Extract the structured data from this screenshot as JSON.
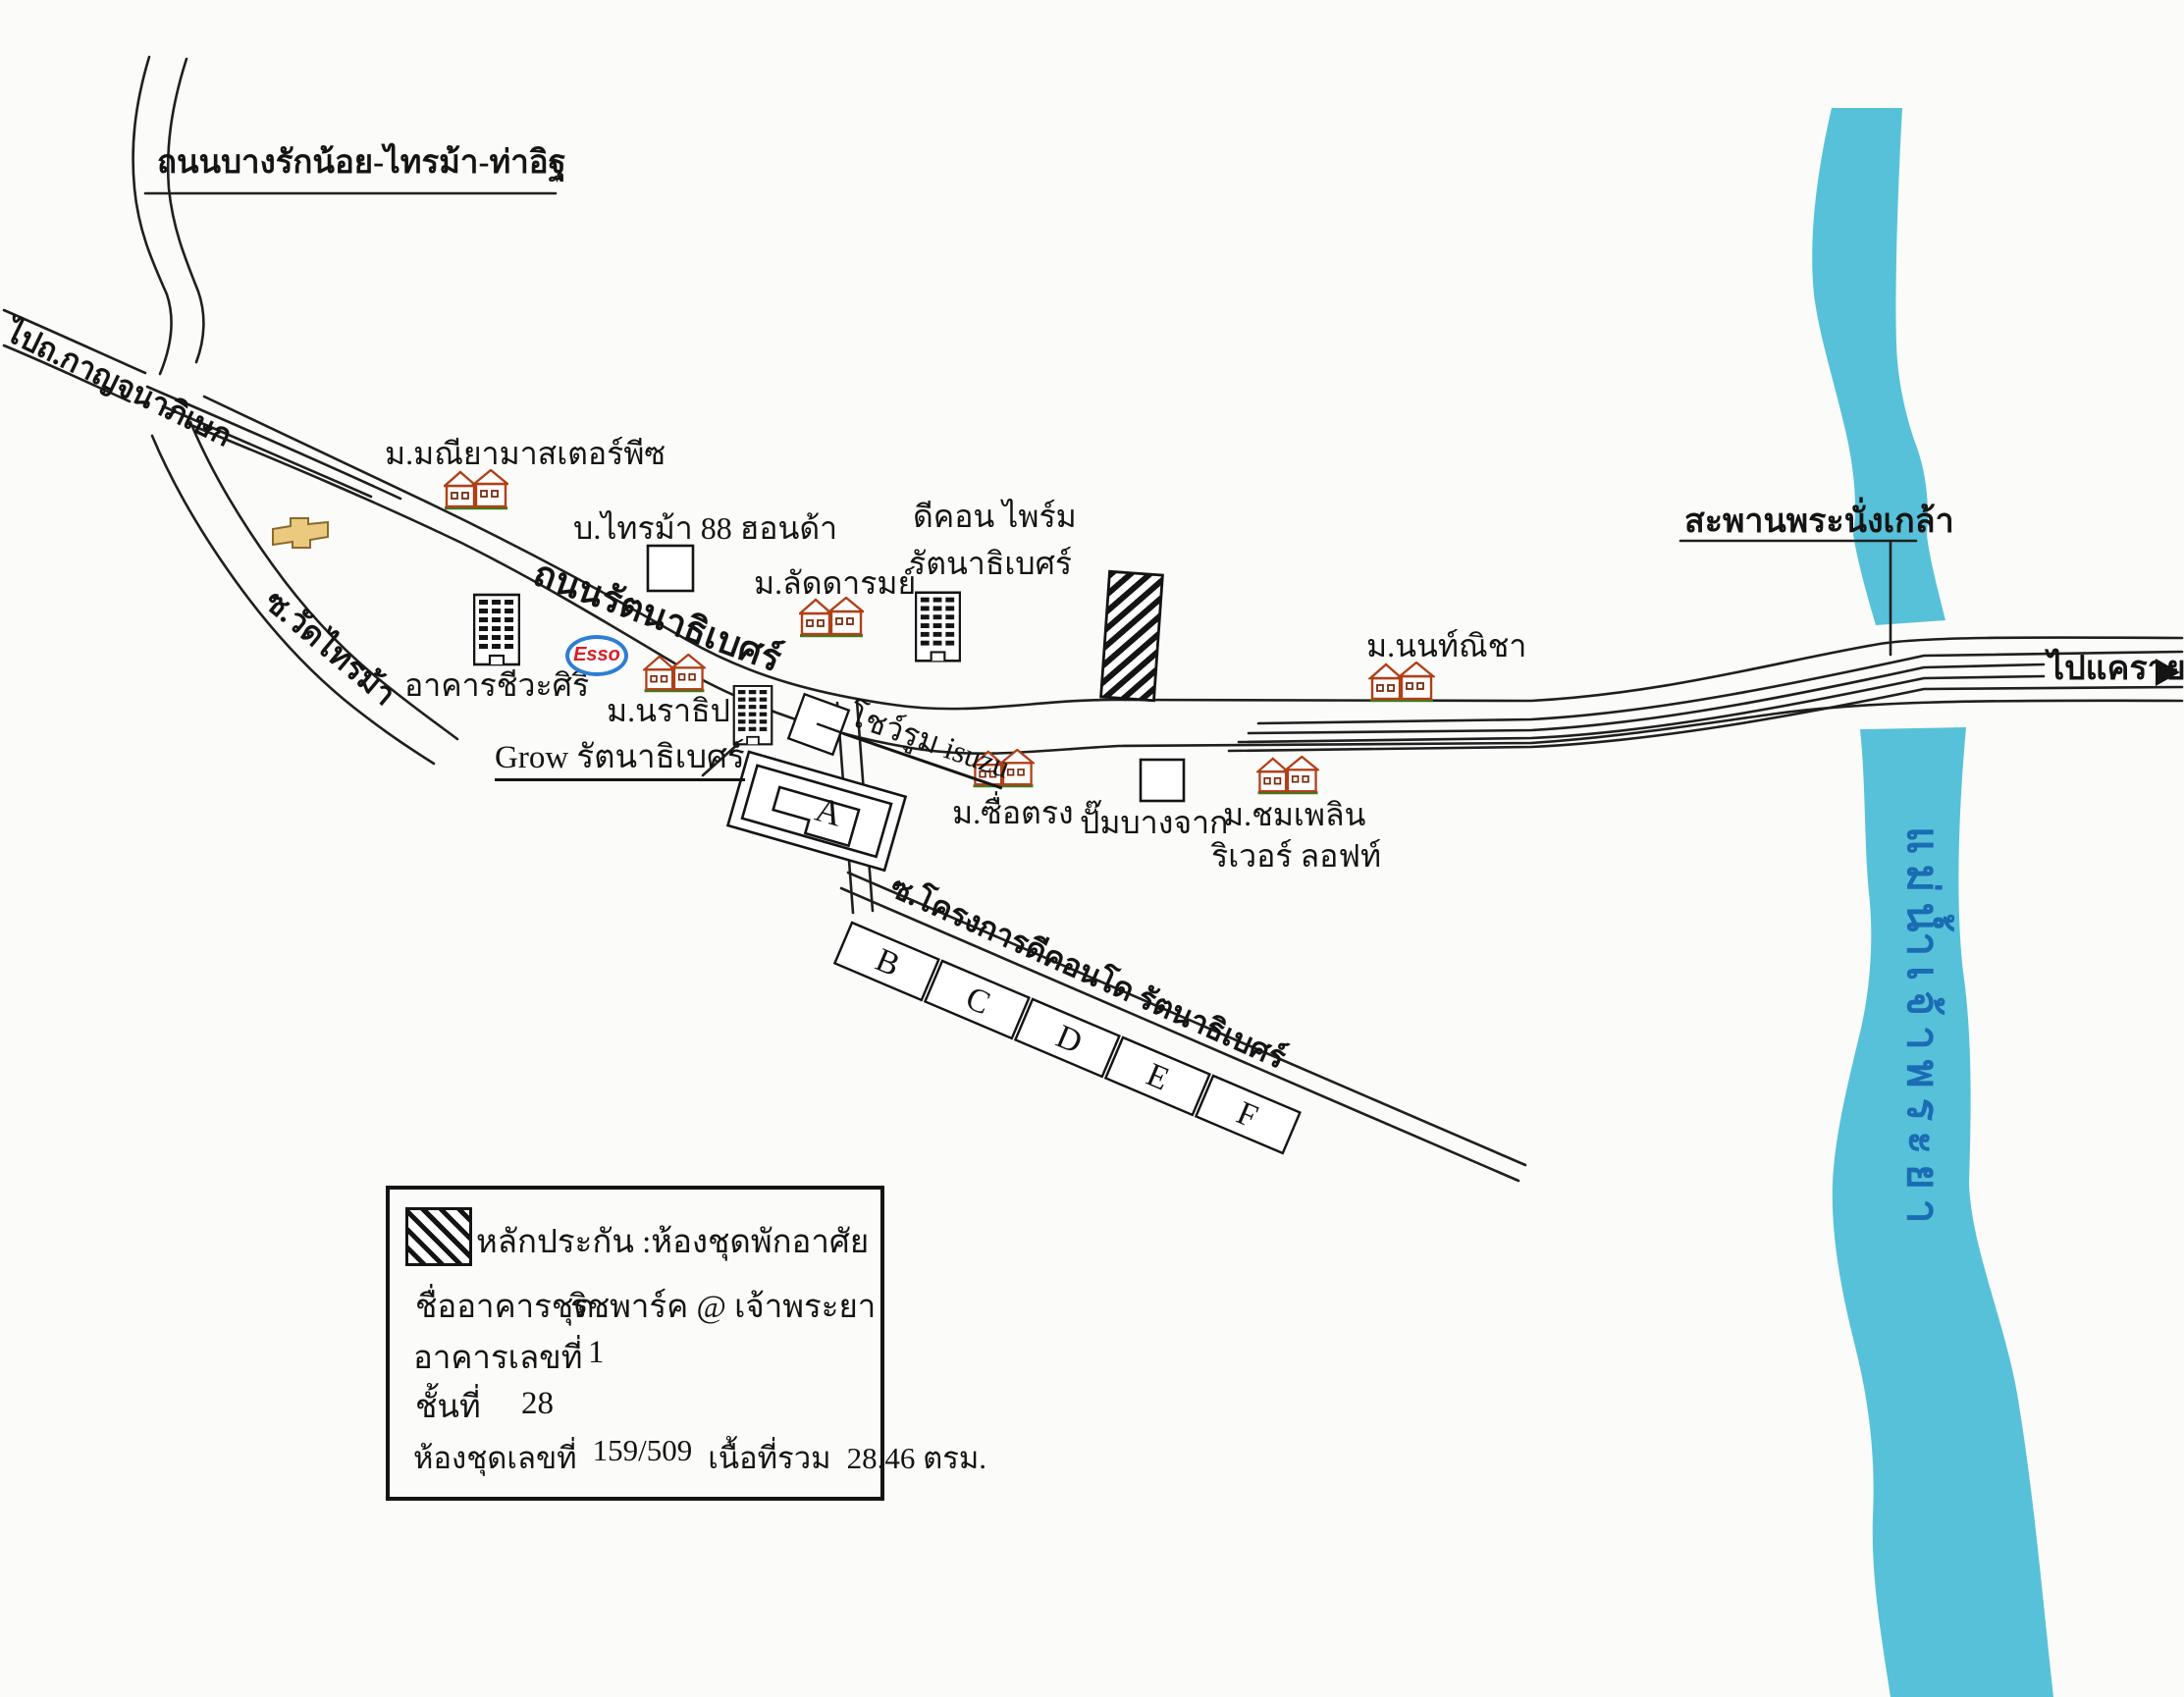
{
  "colors": {
    "paper": "#fbfbf9",
    "road_line": "#1f1f1f",
    "river": "#57c1d9",
    "river_text": "#1a6cb3",
    "house_outline": "#b04018",
    "house_ground": "#3e7a1e",
    "esso_ring_blue": "#2d7ed3",
    "esso_text_red": "#d81f26",
    "chevrolet_gold": "#ebca80"
  },
  "roads": {
    "bangraknoi_saima_thait": "ถนนบางรักน้อย-ไทรม้า-ท่าอิฐ",
    "to_kanchanaphisek": "ไปถ.กาญจนาภิเษก",
    "rattanathibet": "ถนนรัตนาธิเบศร์",
    "soi_wat_saima": "ซ.วัดไทรม้า",
    "soi_dcondo": "ซ.โครงการดีคอนโด รัตนาธิเบศร์",
    "to_khaerai": "ไปแคราย",
    "phranangklao_bridge": "สะพานพระนั่งเกล้า",
    "chaophraya_river": "แม่น้ำเจ้าพระยา"
  },
  "places": {
    "maneeya_masterpiece": "ม.มณียามาสเตอร์พีซ",
    "saima88_honda": "บ.ไทรม้า 88 ฮอนด้า",
    "laddarom": "ม.ลัดดารมย์",
    "dcon_prime_line1": "ดีคอน ไพร์ม",
    "dcon_prime_line2": "รัตนาธิเบศร์",
    "cheewasiri": "อาคารชีวะศิริ",
    "esso": "Esso",
    "narathip": "ม.นราธิป",
    "grow_rattanathibet": "Grow รัตนาธิเบศร์",
    "isuzu_showroom": "โชว์รูม isuzu",
    "suetrong": "ม.ซื่อตรง",
    "bangchak": "ปั๊มบางจาก",
    "chomphloen_line1": "ม.ชมเพลิน",
    "chomphloen_line2": "ริเวอร์ ลอฟท์",
    "nonnicha": "ม.นนท์ณิชา",
    "blocks": [
      "A",
      "B",
      "C",
      "D",
      "E",
      "F"
    ]
  },
  "legend": {
    "collateral": "หลักประกัน :ห้องชุดพักอาศัย",
    "condo_name_label": "ชื่ออาคารชุด",
    "condo_name_value": "ริชพาร์ค @ เจ้าพระยา",
    "building_no_label": "อาคารเลขที่",
    "building_no_value": "1",
    "floor_label": "ชั้นที่",
    "floor_value": "28",
    "unit_no_label": "ห้องชุดเลขที่",
    "unit_no_value": "159/509",
    "area_label": "เนื้อที่รวม",
    "area_value": "28.46 ตรม."
  }
}
